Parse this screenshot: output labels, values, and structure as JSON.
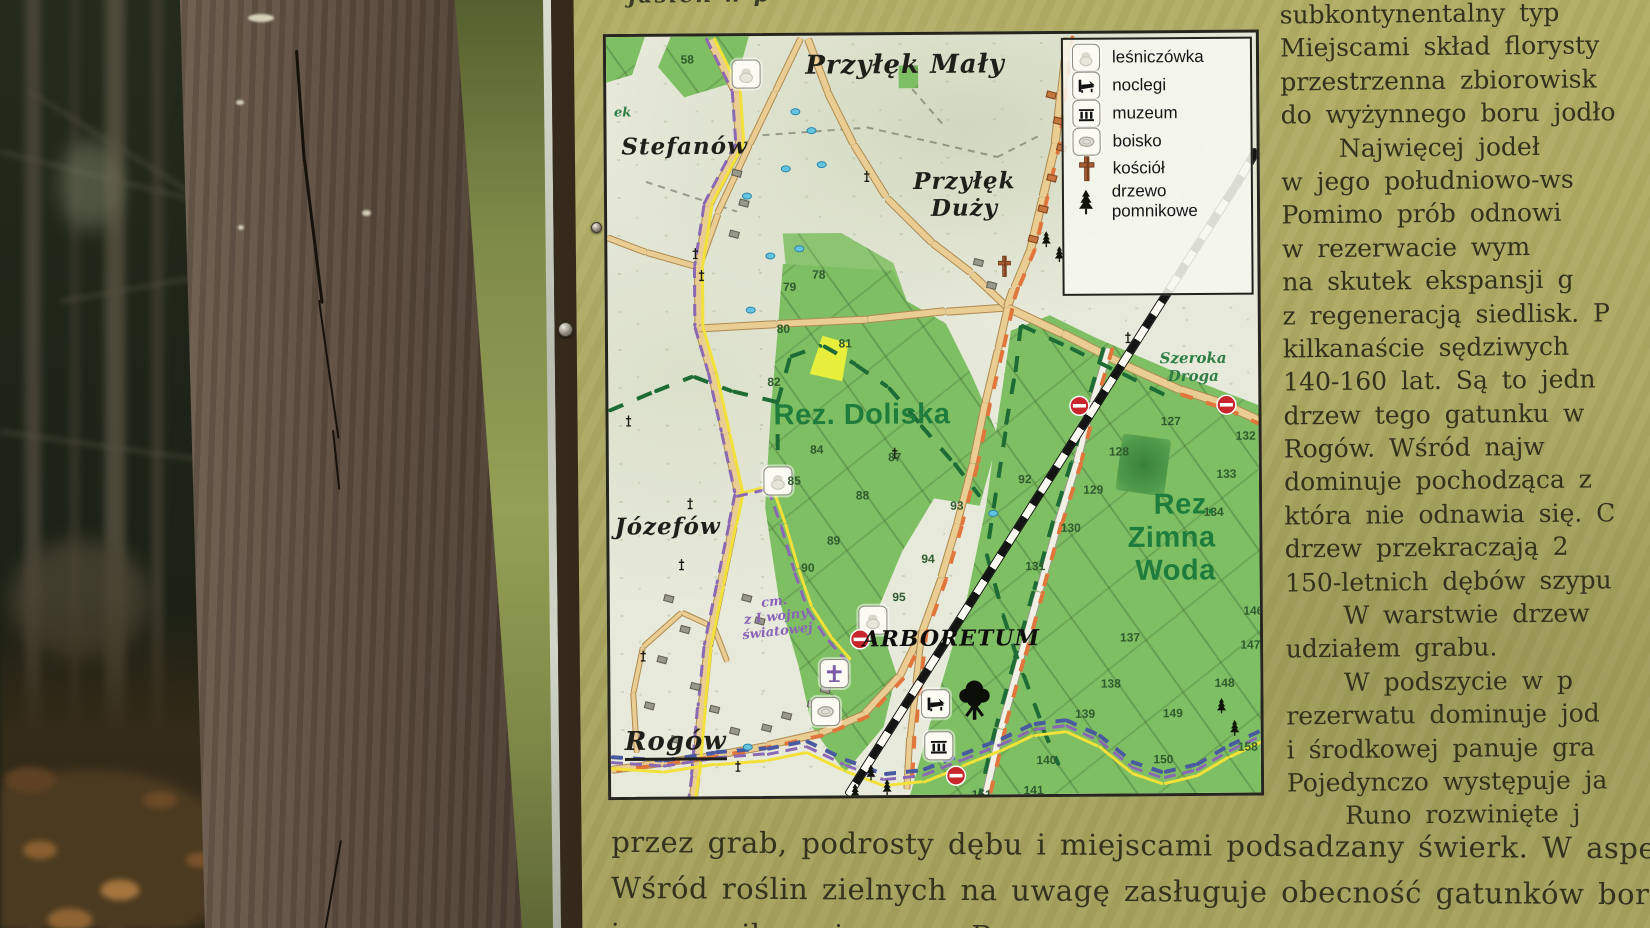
{
  "board": {
    "top_cropped_line": "jasień w p",
    "map": {
      "legend": {
        "items": [
          {
            "icon": "forester-lodge-icon",
            "framed": true,
            "label": "leśniczówka"
          },
          {
            "icon": "lodging-icon",
            "framed": true,
            "label": "noclegi"
          },
          {
            "icon": "museum-icon",
            "framed": true,
            "label": "muzeum"
          },
          {
            "icon": "sports-field-icon",
            "framed": true,
            "label": "boisko"
          },
          {
            "icon": "church-icon",
            "framed": false,
            "label": "kościół"
          },
          {
            "icon": "monument-tree-icon",
            "framed": false,
            "label": "drzewo pomnikowe"
          }
        ]
      },
      "labels": [
        {
          "id": "przylek-maly",
          "text": "Przyłęk Mały",
          "x": 46,
          "y": 4,
          "cls": "village big"
        },
        {
          "id": "stefanow",
          "text": "Stefanów",
          "x": 12,
          "y": 14.5,
          "cls": "village"
        },
        {
          "id": "przylek-duzy",
          "text": "Przyłęk\nDuży",
          "x": 55,
          "y": 21,
          "cls": "village"
        },
        {
          "id": "jozefow",
          "text": "Józefów",
          "x": 9,
          "y": 64.5,
          "cls": "village"
        },
        {
          "id": "rogow",
          "text": "Rogów",
          "x": 10,
          "y": 93,
          "cls": "village big underline"
        },
        {
          "id": "rez-doliska",
          "text": "Rez. Doliska",
          "x": 39,
          "y": 50,
          "cls": "reserve"
        },
        {
          "id": "rez-zimna-woda",
          "text": "Rez.\nZimna Woda",
          "x": 86.5,
          "y": 66.5,
          "cls": "reserve right"
        },
        {
          "id": "szeroka-droga",
          "text": "Szeroka\nDroga",
          "x": 90,
          "y": 44,
          "cls": "road-label"
        },
        {
          "id": "arboretum",
          "text": "ARBORETUM",
          "x": 52.5,
          "y": 79.5,
          "cls": "arboretum"
        },
        {
          "id": "cmentarz-1-wojny",
          "text": "cm.\nz I wojny\nświatowej",
          "x": 25.5,
          "y": 76.5,
          "cls": "cemetery"
        },
        {
          "id": "stream-fragment",
          "text": "ek",
          "x": 2.5,
          "y": 10,
          "cls": "road-label small"
        }
      ],
      "compartment_numbers": [
        {
          "n": "58",
          "x": 12.5,
          "y": 3
        },
        {
          "n": "78",
          "x": 32.5,
          "y": 31.5
        },
        {
          "n": "79",
          "x": 28,
          "y": 33
        },
        {
          "n": "80",
          "x": 27,
          "y": 38.5
        },
        {
          "n": "81",
          "x": 36.5,
          "y": 40.5
        },
        {
          "n": "82",
          "x": 25.5,
          "y": 45.5
        },
        {
          "n": "84",
          "x": 32,
          "y": 54.5
        },
        {
          "n": "85",
          "x": 28.5,
          "y": 58.5
        },
        {
          "n": "87",
          "x": 44,
          "y": 55.5
        },
        {
          "n": "88",
          "x": 39,
          "y": 60.5
        },
        {
          "n": "89",
          "x": 34.5,
          "y": 66.5
        },
        {
          "n": "90",
          "x": 30.5,
          "y": 70
        },
        {
          "n": "92",
          "x": 64,
          "y": 58.5
        },
        {
          "n": "93",
          "x": 53.5,
          "y": 62
        },
        {
          "n": "94",
          "x": 49,
          "y": 69
        },
        {
          "n": "95",
          "x": 44.5,
          "y": 74
        },
        {
          "n": "127",
          "x": 86.5,
          "y": 51
        },
        {
          "n": "128",
          "x": 78.5,
          "y": 55
        },
        {
          "n": "129",
          "x": 74.5,
          "y": 60
        },
        {
          "n": "130",
          "x": 71,
          "y": 65
        },
        {
          "n": "131",
          "x": 65.5,
          "y": 70
        },
        {
          "n": "132",
          "x": 98,
          "y": 53
        },
        {
          "n": "133",
          "x": 95,
          "y": 58
        },
        {
          "n": "134",
          "x": 93,
          "y": 63
        },
        {
          "n": "137",
          "x": 80,
          "y": 79.5
        },
        {
          "n": "138",
          "x": 77,
          "y": 85.5
        },
        {
          "n": "139",
          "x": 73,
          "y": 89.5
        },
        {
          "n": "140",
          "x": 67,
          "y": 95.5
        },
        {
          "n": "141",
          "x": 65,
          "y": 99.5
        },
        {
          "n": "146",
          "x": 99,
          "y": 76
        },
        {
          "n": "147",
          "x": 98.5,
          "y": 80.5
        },
        {
          "n": "148",
          "x": 94.5,
          "y": 85.5
        },
        {
          "n": "149",
          "x": 86.5,
          "y": 89.5
        },
        {
          "n": "150",
          "x": 85,
          "y": 95.5
        },
        {
          "n": "151",
          "x": 57,
          "y": 100
        },
        {
          "n": "158",
          "x": 98,
          "y": 94
        }
      ],
      "features": {
        "icon_boxes": [
          {
            "icon": "forester-lodge-icon",
            "x": 21.5,
            "y": 5
          },
          {
            "icon": "forester-lodge-icon",
            "x": 26,
            "y": 58.5
          },
          {
            "icon": "forester-lodge-icon",
            "x": 40.5,
            "y": 77
          },
          {
            "icon": "chapel-cross-icon",
            "x": 34.5,
            "y": 84
          },
          {
            "icon": "sports-field-icon",
            "x": 33,
            "y": 89
          },
          {
            "icon": "lodging-icon",
            "x": 50,
            "y": 88
          },
          {
            "icon": "museum-icon",
            "x": 50.5,
            "y": 93.5
          }
        ],
        "church_symbol": {
          "x": 61,
          "y": 30.5
        },
        "big_tree_symbol": {
          "x": 56,
          "y": 87.5
        },
        "no_entry_signs": [
          [
            38.5,
            79.5
          ],
          [
            53,
            97.5
          ],
          [
            72.5,
            49
          ],
          [
            95,
            49
          ]
        ],
        "wayside_crosses": [
          [
            13.5,
            28.5
          ],
          [
            14.5,
            31.5
          ],
          [
            40,
            18.5
          ],
          [
            80,
            40
          ],
          [
            3,
            50.5
          ],
          [
            12.5,
            61.5
          ],
          [
            11,
            69.5
          ],
          [
            5,
            81.5
          ],
          [
            19.5,
            96
          ],
          [
            44,
            55
          ]
        ],
        "monument_trees": [
          [
            67.5,
            27
          ],
          [
            69.5,
            29
          ],
          [
            40,
            97
          ],
          [
            42.5,
            99
          ],
          [
            37.5,
            99.5
          ],
          [
            94,
            88.5
          ],
          [
            96,
            91.5
          ]
        ],
        "ponds": [
          [
            29,
            10
          ],
          [
            31.5,
            12.5
          ],
          [
            27.5,
            17.5
          ],
          [
            33,
            17
          ],
          [
            21.5,
            21
          ],
          [
            25,
            29
          ],
          [
            29.5,
            28
          ],
          [
            22,
            36
          ],
          [
            21,
            93.5
          ],
          [
            59,
            63
          ]
        ],
        "buildings_orange": [
          [
            68.5,
            8
          ],
          [
            69.5,
            11.5
          ],
          [
            70,
            15
          ],
          [
            68.5,
            19
          ],
          [
            67,
            23
          ],
          [
            65.5,
            27
          ]
        ],
        "buildings_grey": [
          [
            9,
            74
          ],
          [
            11.5,
            78
          ],
          [
            8,
            82
          ],
          [
            13,
            85.5
          ],
          [
            6,
            88
          ],
          [
            16,
            88.5
          ],
          [
            27,
            89.5
          ],
          [
            31,
            88
          ],
          [
            24,
            91
          ],
          [
            19,
            91.5
          ],
          [
            10,
            92.5
          ],
          [
            33,
            86
          ],
          [
            36,
            84.5
          ],
          [
            59,
            33
          ],
          [
            57,
            30
          ],
          [
            21,
            74
          ],
          [
            23,
            77
          ],
          [
            20,
            18
          ],
          [
            21,
            22
          ],
          [
            19.5,
            26
          ]
        ]
      }
    },
    "right_column": {
      "lines": [
        {
          "text": "subkontynentalny typ",
          "indent": false
        },
        {
          "text": "Miejscami skład florysty",
          "indent": false
        },
        {
          "text": "przestrzenna zbiorowisk",
          "indent": false
        },
        {
          "text": "do wyżynnego boru jodło",
          "indent": false
        },
        {
          "text": "Najwięcej jodeł",
          "indent": true
        },
        {
          "text": "w jego południowo-ws",
          "indent": false
        },
        {
          "text": "Pomimo prób odnowi",
          "indent": false
        },
        {
          "text": "w rezerwacie wym",
          "indent": false
        },
        {
          "text": "na skutek ekspansji g",
          "indent": false
        },
        {
          "text": "z regeneracją siedlisk. P",
          "indent": false
        },
        {
          "text": "kilkanaście sędziwych",
          "indent": false
        },
        {
          "text": "140-160 lat. Są to jedn",
          "indent": false
        },
        {
          "text": "drzew tego gatunku w",
          "indent": false
        },
        {
          "text": "Rogów. Wśród najw",
          "indent": false
        },
        {
          "text": "dominuje pochodząca z",
          "indent": false
        },
        {
          "text": "która nie odnawia się. C",
          "indent": false
        },
        {
          "text": "drzew przekraczają 2",
          "indent": false
        },
        {
          "text": "150-letnich dębów szypu",
          "indent": false
        },
        {
          "text": "W warstwie drzew",
          "indent": true
        },
        {
          "text": "udziałem grabu.",
          "indent": false
        },
        {
          "text": "W podszycie w p",
          "indent": true
        },
        {
          "text": "rezerwatu dominuje jod",
          "indent": false
        },
        {
          "text": "i środkowej panuje gra",
          "indent": false
        },
        {
          "text": "Pojedynczo występuje ja",
          "indent": false
        },
        {
          "text": "Runo rozwinięte j",
          "indent": true
        }
      ]
    },
    "bottom_lines": [
      "przez grab, podrosty dębu i miejscami podsadzany świerk. W aspekcie wiosenn",
      "Wśród roślin zielnych na uwagę zasługuje obecność gatunków borowych: widłaka",
      "i szczawika zajęczego. Rza"
    ],
    "colors": {
      "board_background": "#aca862",
      "map_paper": "#e7e9da",
      "forest_green": "#7fbf63",
      "reserve_dark_green": "#4f9a4a",
      "clearing_yellow": "#eef23a",
      "road_fill": "#e9cd92",
      "trail_yellow": "#f2e138",
      "trail_purple": "#8a68b4",
      "trail_orange": "#e0763c",
      "trail_green": "#1d6b35",
      "trail_blue": "#4a5aa0",
      "no_entry_red": "#c9252c",
      "reserve_label_green": "#1e7c3c",
      "cemetery_purple": "#8a63b8",
      "text_dark": "#33301d"
    }
  }
}
